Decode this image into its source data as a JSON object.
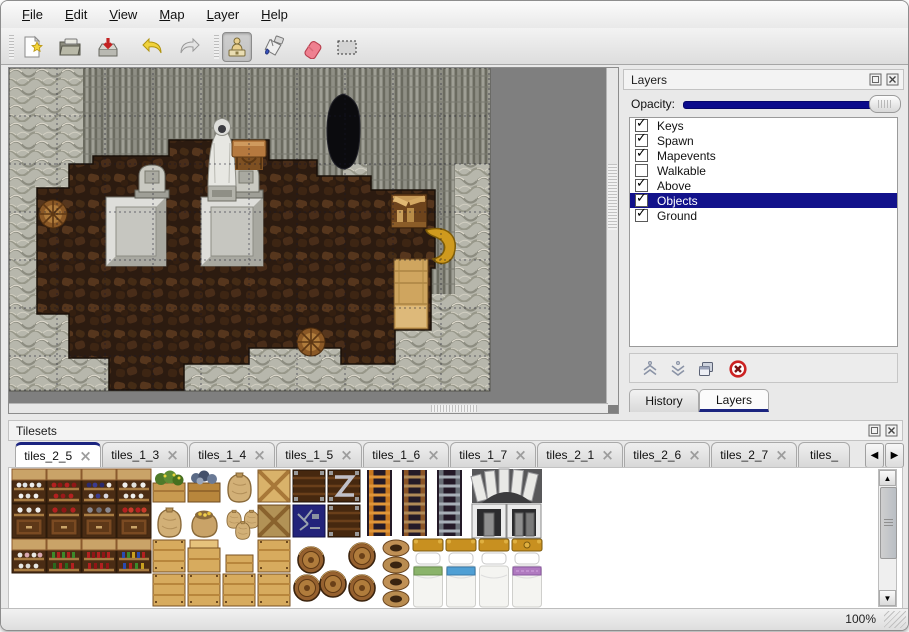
{
  "menu": {
    "items": [
      "File",
      "Edit",
      "View",
      "Map",
      "Layer",
      "Help"
    ]
  },
  "toolbar": {
    "buttons": [
      {
        "name": "new-file-button",
        "icon": "new-page-icon"
      },
      {
        "name": "open-button",
        "icon": "open-folder-icon"
      },
      {
        "name": "save-button",
        "icon": "save-disk-icon"
      },
      {
        "name": "undo-button",
        "icon": "undo-arrow-icon"
      },
      {
        "name": "redo-button",
        "icon": "redo-arrow-icon"
      },
      {
        "name": "stamp-tool-button",
        "icon": "stamp-icon",
        "active": true
      },
      {
        "name": "fill-tool-button",
        "icon": "paint-bucket-icon"
      },
      {
        "name": "eraser-tool-button",
        "icon": "eraser-icon"
      },
      {
        "name": "select-tool-button",
        "icon": "selection-rect-icon"
      }
    ]
  },
  "layers_panel": {
    "title": "Layers",
    "opacity_label": "Opacity:",
    "layers": [
      {
        "name": "Keys",
        "checked": true,
        "selected": false
      },
      {
        "name": "Spawn",
        "checked": true,
        "selected": false
      },
      {
        "name": "Mapevents",
        "checked": true,
        "selected": false
      },
      {
        "name": "Walkable",
        "checked": false,
        "selected": false
      },
      {
        "name": "Above",
        "checked": true,
        "selected": false
      },
      {
        "name": "Objects",
        "checked": true,
        "selected": true
      },
      {
        "name": "Ground",
        "checked": true,
        "selected": false
      }
    ],
    "buttons": [
      {
        "name": "raise-layer-button",
        "icon": "chevrons-up-icon"
      },
      {
        "name": "lower-layer-button",
        "icon": "chevrons-down-icon"
      },
      {
        "name": "duplicate-layer-button",
        "icon": "duplicate-icon"
      },
      {
        "name": "delete-layer-button",
        "icon": "delete-circle-icon"
      }
    ],
    "dock_tabs": [
      {
        "label": "History",
        "active": false
      },
      {
        "label": "Layers",
        "active": true
      }
    ]
  },
  "tilesets_panel": {
    "title": "Tilesets",
    "tabs": [
      {
        "label": "tiles_2_5",
        "active": true
      },
      {
        "label": "tiles_1_3",
        "active": false
      },
      {
        "label": "tiles_1_4",
        "active": false
      },
      {
        "label": "tiles_1_5",
        "active": false
      },
      {
        "label": "tiles_1_6",
        "active": false
      },
      {
        "label": "tiles_1_7",
        "active": false
      },
      {
        "label": "tiles_2_1",
        "active": false
      },
      {
        "label": "tiles_2_6",
        "active": false
      },
      {
        "label": "tiles_2_7",
        "active": false
      },
      {
        "label": "tiles_",
        "active": false,
        "truncated": true
      }
    ],
    "scroll_left": "◀",
    "scroll_right": "▶",
    "scroll_up": "▲",
    "scroll_down": "▼"
  },
  "statusbar": {
    "zoom": "100%"
  },
  "colors": {
    "selection_navy": "#12128b",
    "slider_navy": "#0b0b8b",
    "tab_accent_navy": "#1b2480",
    "map_backdrop_gray": "#7f7f7f",
    "delete_red": "#cc2222"
  }
}
